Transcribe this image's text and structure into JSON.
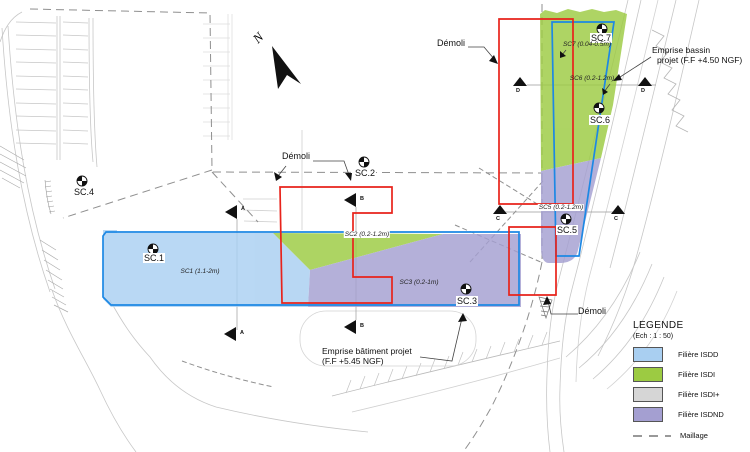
{
  "colors": {
    "isdd": "#A9CFF1",
    "isdi": "#9CCB42",
    "isdi_plus": "#D6D6D6",
    "isdnd": "#A49FD1",
    "emprise": "#1D88E4",
    "demolition": "#E8231B"
  },
  "legend": {
    "title": "LEGENDE",
    "scale": "(Ech :  1 : 50)",
    "items": [
      {
        "label": "Filière ISDD"
      },
      {
        "label": "Filière ISDI"
      },
      {
        "label": "Filière ISDI+"
      },
      {
        "label": "Filière ISDND"
      }
    ],
    "maillage": "Maillage"
  },
  "labels": {
    "demoli": "Démoli",
    "emprise_bassin_1": "Emprise bassin",
    "emprise_bassin_2": "projet (F.F +4.50 NGF)",
    "emprise_batiment_1": "Emprise bâtiment projet",
    "emprise_batiment_2": "(F.F +5.45 NGF)",
    "north": "N"
  },
  "soundings": {
    "sc1": {
      "id": "SC.1",
      "note": "SC1 (1.1-2m)"
    },
    "sc2": {
      "id": "SC.2",
      "note": "SC2 (0.2-1.2m)"
    },
    "sc3": {
      "id": "SC.3",
      "note": "SC3 (0.2-1m)"
    },
    "sc4": {
      "id": "SC.4"
    },
    "sc5": {
      "id": "SC.5",
      "note": "SC5 (0.2-1.2m)"
    },
    "sc6": {
      "id": "SC.6",
      "note": "SC6 (0.2-1.2m)"
    },
    "sc7": {
      "id": "SC.7",
      "note": "SC7 (0.04-0.5m)"
    }
  },
  "sections": {
    "a": "A",
    "b": "B",
    "c": "C",
    "d": "D"
  }
}
